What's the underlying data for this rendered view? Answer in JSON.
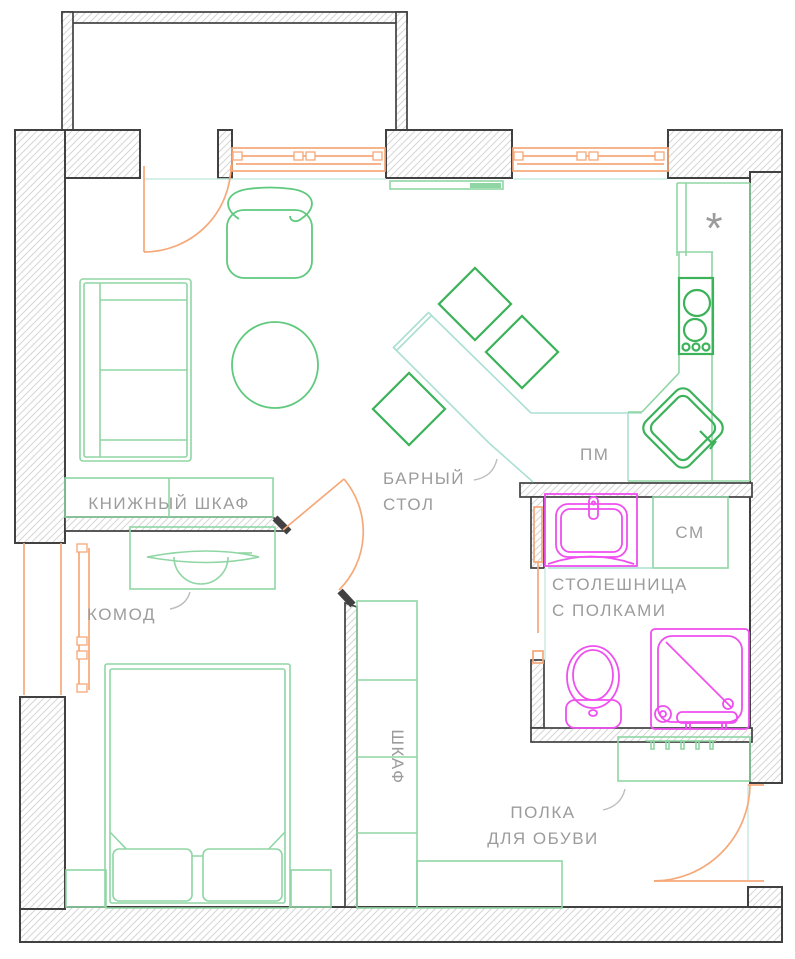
{
  "title": "apartment-floor-plan",
  "labels": {
    "bookcase": "КНИЖНЫЙ ШКАФ",
    "dresser": "КОМОД",
    "bar_table_line1": "БАРНЫЙ",
    "bar_table_line2": "СТОЛ",
    "dishwasher": "ПМ",
    "washing_machine": "СМ",
    "countertop_line1": "СТОЛЕШНИЦА",
    "countertop_line2": "С ПОЛКАМИ",
    "wardrobe": "ШКАФ",
    "shoe_shelf_line1": "ПОЛКА",
    "shoe_shelf_line2": "ДЛЯ ОБУВИ",
    "fridge_marker": "*"
  },
  "colors": {
    "wall_outline": "#414141",
    "hatch_gray": "#d6d6d6",
    "furniture_green": "#8fd6a4",
    "mid_green": "#5fc97e",
    "accent_green": "#3cb25a",
    "window_door_orange": "#f6a878",
    "plumbing_magenta": "#ef4fef",
    "counter_teal": "#abdfd4",
    "sill_teal": "#c6ebe2",
    "label_gray": "#9c9c9c"
  }
}
